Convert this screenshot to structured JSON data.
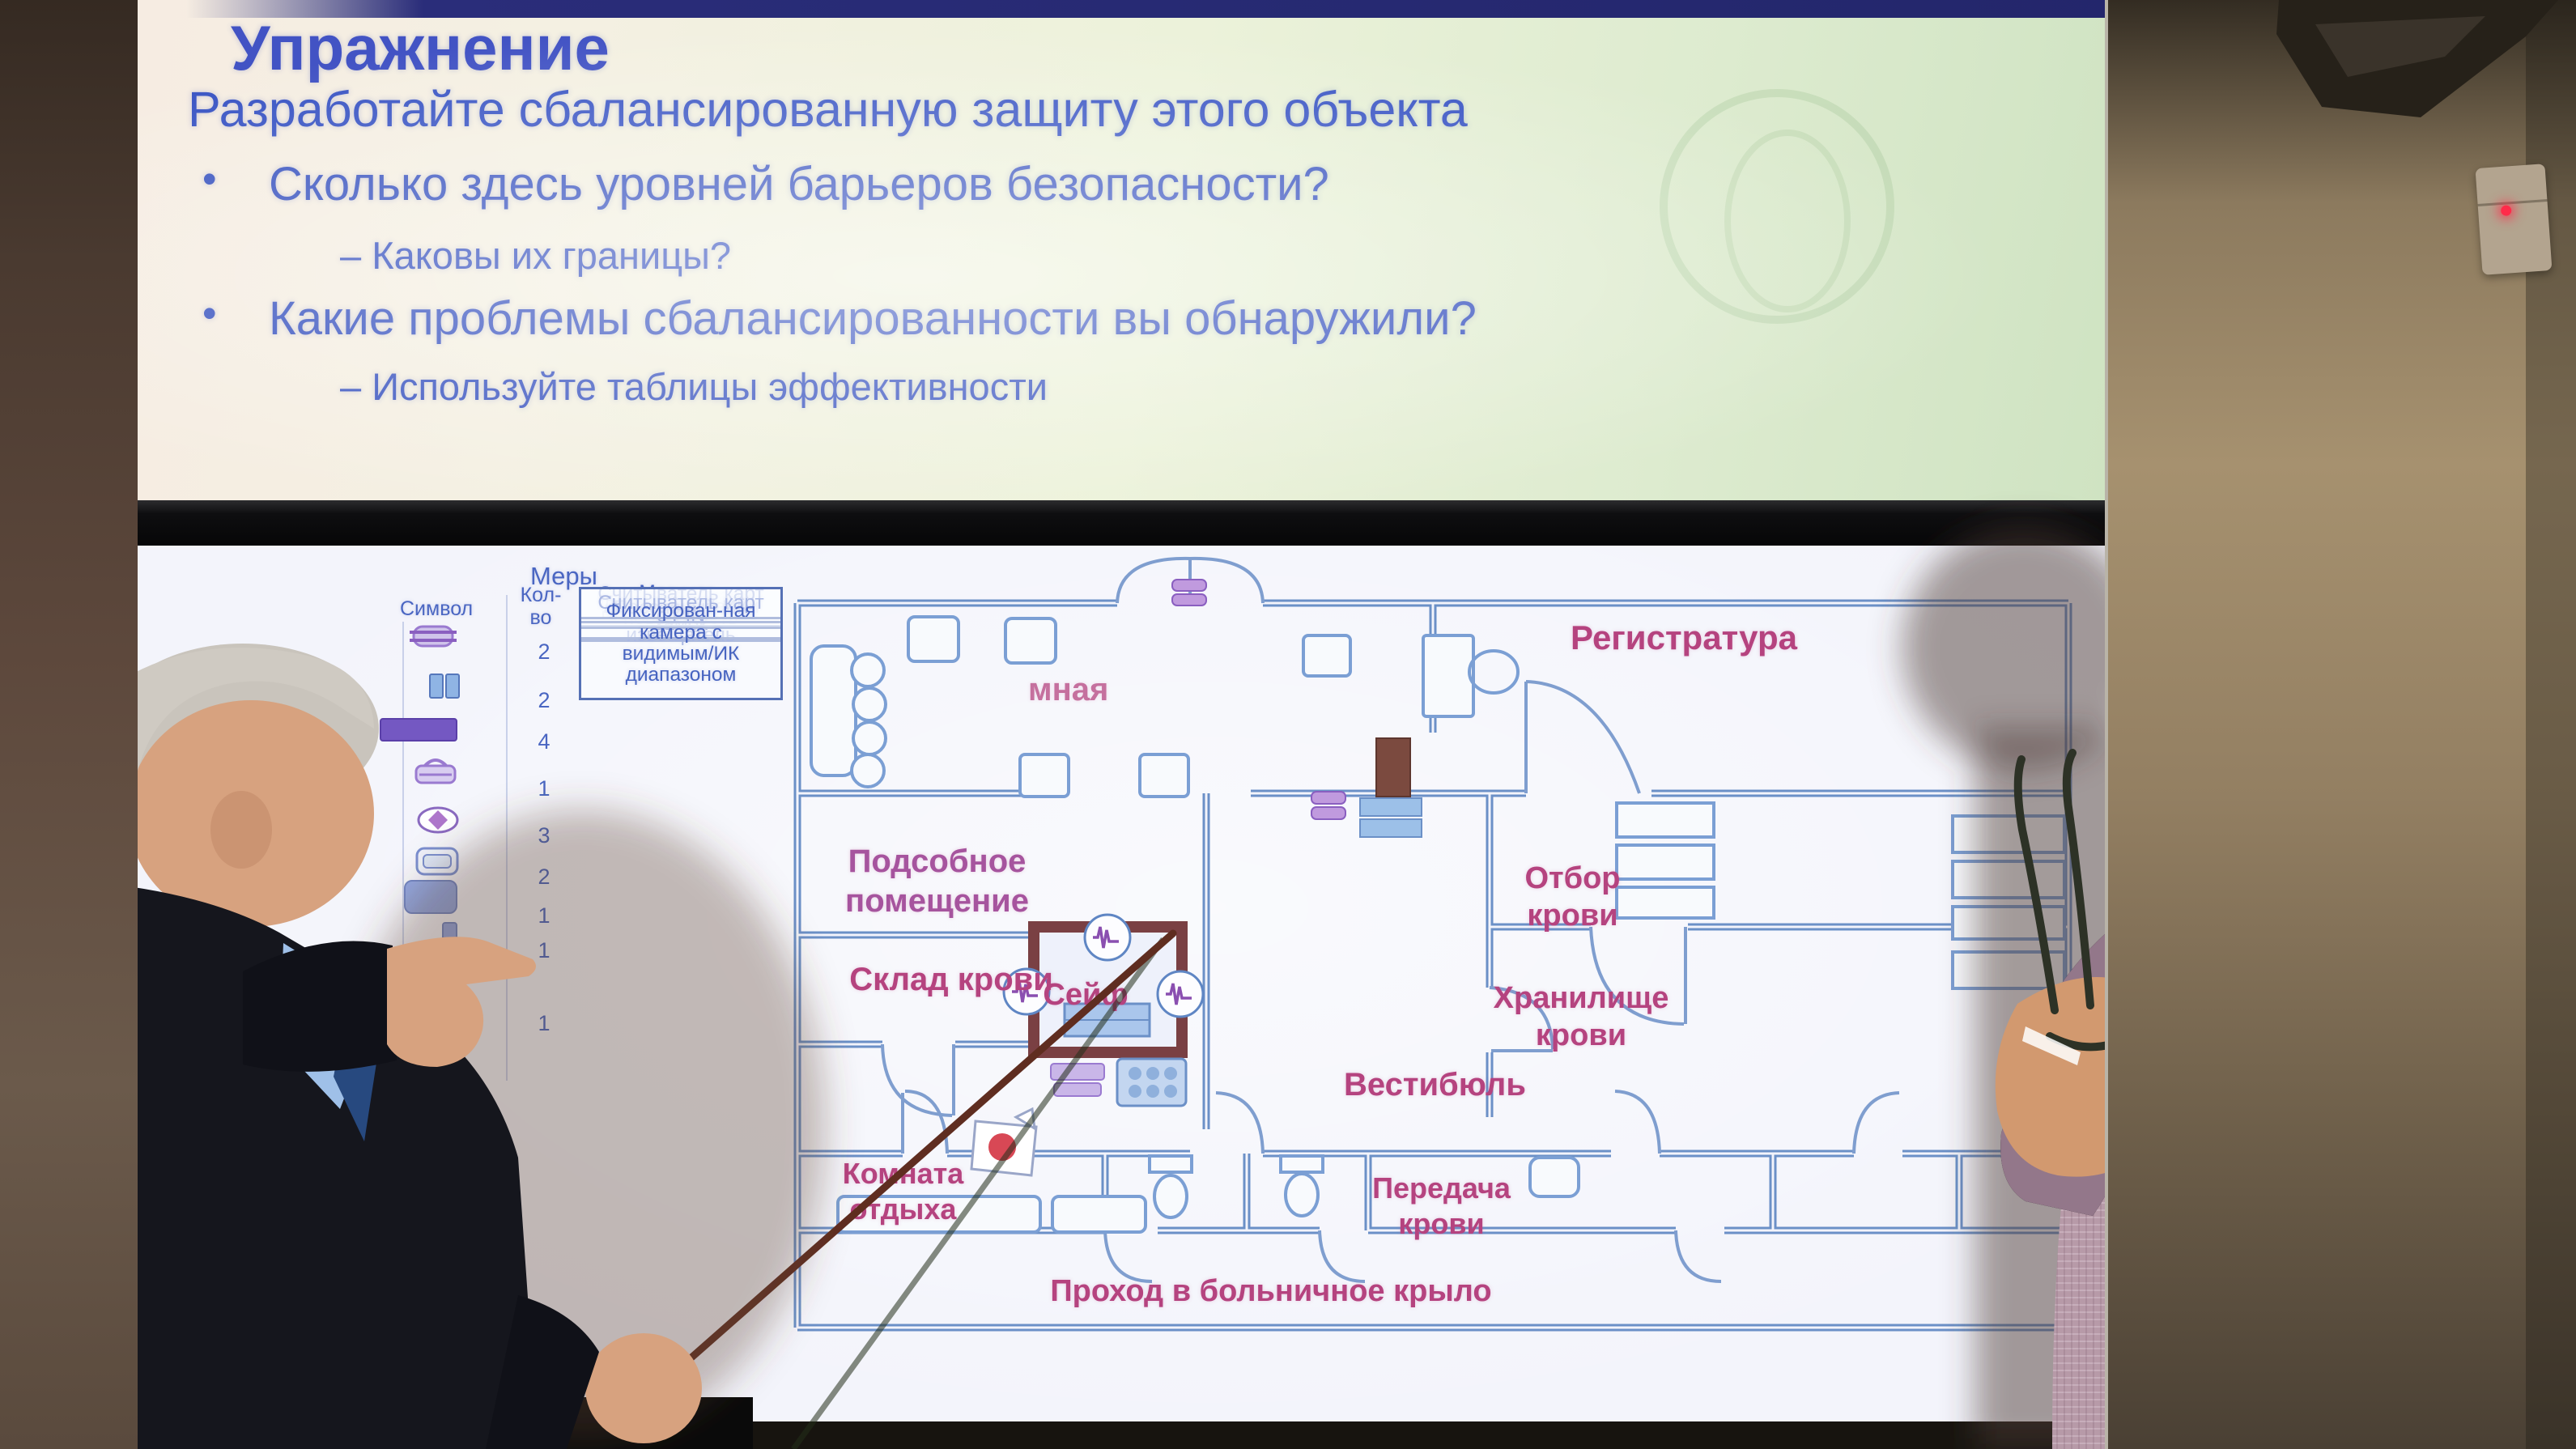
{
  "slide": {
    "title": "Упражнение",
    "subtitle": "Разработайте сбалансированную защиту этого объекта",
    "bullet1": "Сколько здесь уровней барьеров безопасности?",
    "sub1": "–  Каковы их границы?",
    "bullet2": "Какие проблемы сбалансированности вы обнаружили?",
    "sub2": "–  Используйте таблицы эффективности"
  },
  "measures_table": {
    "title": "Меры",
    "symbol_header": "Символ",
    "qty_header": "Кол-\nво",
    "device_header": "Устройство",
    "rows": [
      {
        "symbol": "magnetic-contact-detector-icon",
        "qty": "2",
        "device": "Магнито-\nконтактный\nизвещатель"
      },
      {
        "symbol": "magnetic-lock-icon",
        "qty": "2",
        "device": "Магнитный замок"
      },
      {
        "symbol": "hardened-surface-icon",
        "qty": "4",
        "device": "Укрепленная\nповерхность"
      },
      {
        "symbol": "electric-lock-icon",
        "qty": "1",
        "device": "Электричес-кий\nзамок"
      },
      {
        "symbol": "vibration-sensor-icon",
        "qty": "3",
        "device": "Датчик вибрации"
      },
      {
        "symbol": "passive-ir-icon",
        "qty": "2",
        "device": "Пассивный ИК"
      },
      {
        "symbol": "card-reader-pin-icon",
        "qty": "1",
        "device": "Считыватель карт\nс PIN"
      },
      {
        "symbol": "card-reader-icon",
        "qty": "1",
        "device": "Считыватель карт"
      },
      {
        "symbol": "fixed-camera-icon",
        "qty": "1",
        "device": "Фиксирован-ная\nкамера с\nвидимым/ИК\nдиапазоном"
      }
    ]
  },
  "floor_plan": {
    "rooms": {
      "reception_partial": "мная",
      "registry": "Регистратура",
      "utility": "Подсобное\nпомещение",
      "blood_draw": "Отбор\nкрови",
      "blood_store": "Склад крови",
      "safe": "Сейф",
      "blood_vault": "Хранилище\nкрови",
      "vestibule": "Вестибюль",
      "rest_room": "Комната\nотдыха",
      "blood_transfer": "Передача\nкрови",
      "corridor": "Проход в больничное крыло"
    }
  },
  "colors": {
    "slide_title": "#4253c4",
    "slide_body": "#3b55c0",
    "room_label": "#b5437f",
    "plan_wall": "#6b90c7",
    "safe_wall": "#7a4043",
    "table_text": "#4a66c2",
    "sensor_led": "#ff2b4a"
  }
}
